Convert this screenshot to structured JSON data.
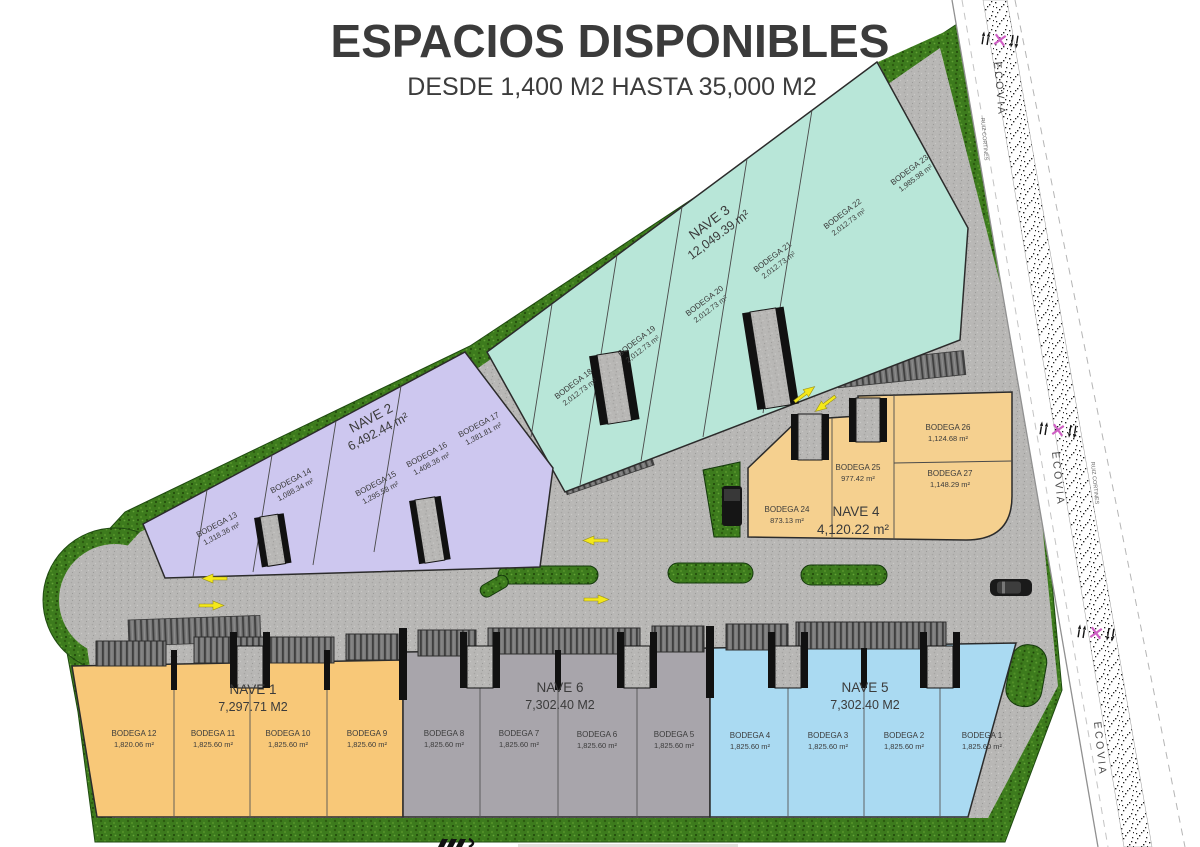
{
  "title": "ESPACIOS DISPONIBLES",
  "subtitle": "DESDE 1,400 M2 HASTA 35,000 M2",
  "colors": {
    "title_navy": "#2d3d52",
    "nave1_orange": "#f8c878",
    "nave2_purple": "#cdc7ef",
    "nave3_teal": "#b8e6d8",
    "nave4_tan": "#f5d08f",
    "nave5_blue": "#aadaf2",
    "nave6_gray": "#a8a5ab",
    "grass_green": "#3d7b1d",
    "pavement_gray": "#b8b7b5",
    "arrow_yellow": "#f4e81a",
    "road_marker_pink": "#cf5fc4"
  },
  "naves": [
    {
      "label": "NAVE 1",
      "area": "7,297.71 M2",
      "bodegas": [
        {
          "name": "BODEGA 12",
          "area": "1,820.06 m²"
        },
        {
          "name": "BODEGA 11",
          "area": "1,825.60 m²"
        },
        {
          "name": "BODEGA 10",
          "area": "1,825.60 m²"
        },
        {
          "name": "BODEGA 9",
          "area": "1,825.60 m²"
        }
      ]
    },
    {
      "label": "NAVE 2",
      "area": "6,492.44 m²",
      "bodegas": [
        {
          "name": "BODEGA 13",
          "area": "1,318.36 m²"
        },
        {
          "name": "BODEGA 14",
          "area": "1,088.34 m²"
        },
        {
          "name": "BODEGA 15",
          "area": "1,295.58 m²"
        },
        {
          "name": "BODEGA 16",
          "area": "1,408.36 m²"
        },
        {
          "name": "BODEGA 17",
          "area": "1,381.81 m²"
        }
      ]
    },
    {
      "label": "NAVE 3",
      "area": "12,049.39 m²",
      "bodegas": [
        {
          "name": "BODEGA 18",
          "area": "2,012.73 m²"
        },
        {
          "name": "BODEGA 19",
          "area": "2,012.73 m²"
        },
        {
          "name": "BODEGA 20",
          "area": "2,012.73 m²"
        },
        {
          "name": "BODEGA 21",
          "area": "2,012.73 m²"
        },
        {
          "name": "BODEGA 22",
          "area": "2,012.73 m²"
        },
        {
          "name": "BODEGA 23",
          "area": "1,985.98 m²"
        }
      ]
    },
    {
      "label": "NAVE 4",
      "area": "4,120.22 m²",
      "bodegas": [
        {
          "name": "BODEGA 24",
          "area": "873.13 m²"
        },
        {
          "name": "BODEGA 25",
          "area": "977.42 m²"
        },
        {
          "name": "BODEGA 26",
          "area": "1,124.68 m²"
        },
        {
          "name": "BODEGA 27",
          "area": "1,148.29 m²"
        }
      ]
    },
    {
      "label": "NAVE 5",
      "area": "7,302.40 M2",
      "bodegas": [
        {
          "name": "BODEGA 4",
          "area": "1,825.60 m²"
        },
        {
          "name": "BODEGA 3",
          "area": "1,825.60 m²"
        },
        {
          "name": "BODEGA 2",
          "area": "1,825.60 m²"
        },
        {
          "name": "BODEGA 1",
          "area": "1,825.60 m²"
        }
      ]
    },
    {
      "label": "NAVE 6",
      "area": "7,302.40 M2",
      "bodegas": [
        {
          "name": "BODEGA 8",
          "area": "1,825.60 m²"
        },
        {
          "name": "BODEGA 7",
          "area": "1,825.60 m²"
        },
        {
          "name": "BODEGA 6",
          "area": "1,825.60 m²"
        },
        {
          "name": "BODEGA 5",
          "area": "1,825.60 m²"
        }
      ]
    }
  ],
  "road": {
    "name": "ECOVIA",
    "cross_street": "RUIZ CORTINES"
  }
}
